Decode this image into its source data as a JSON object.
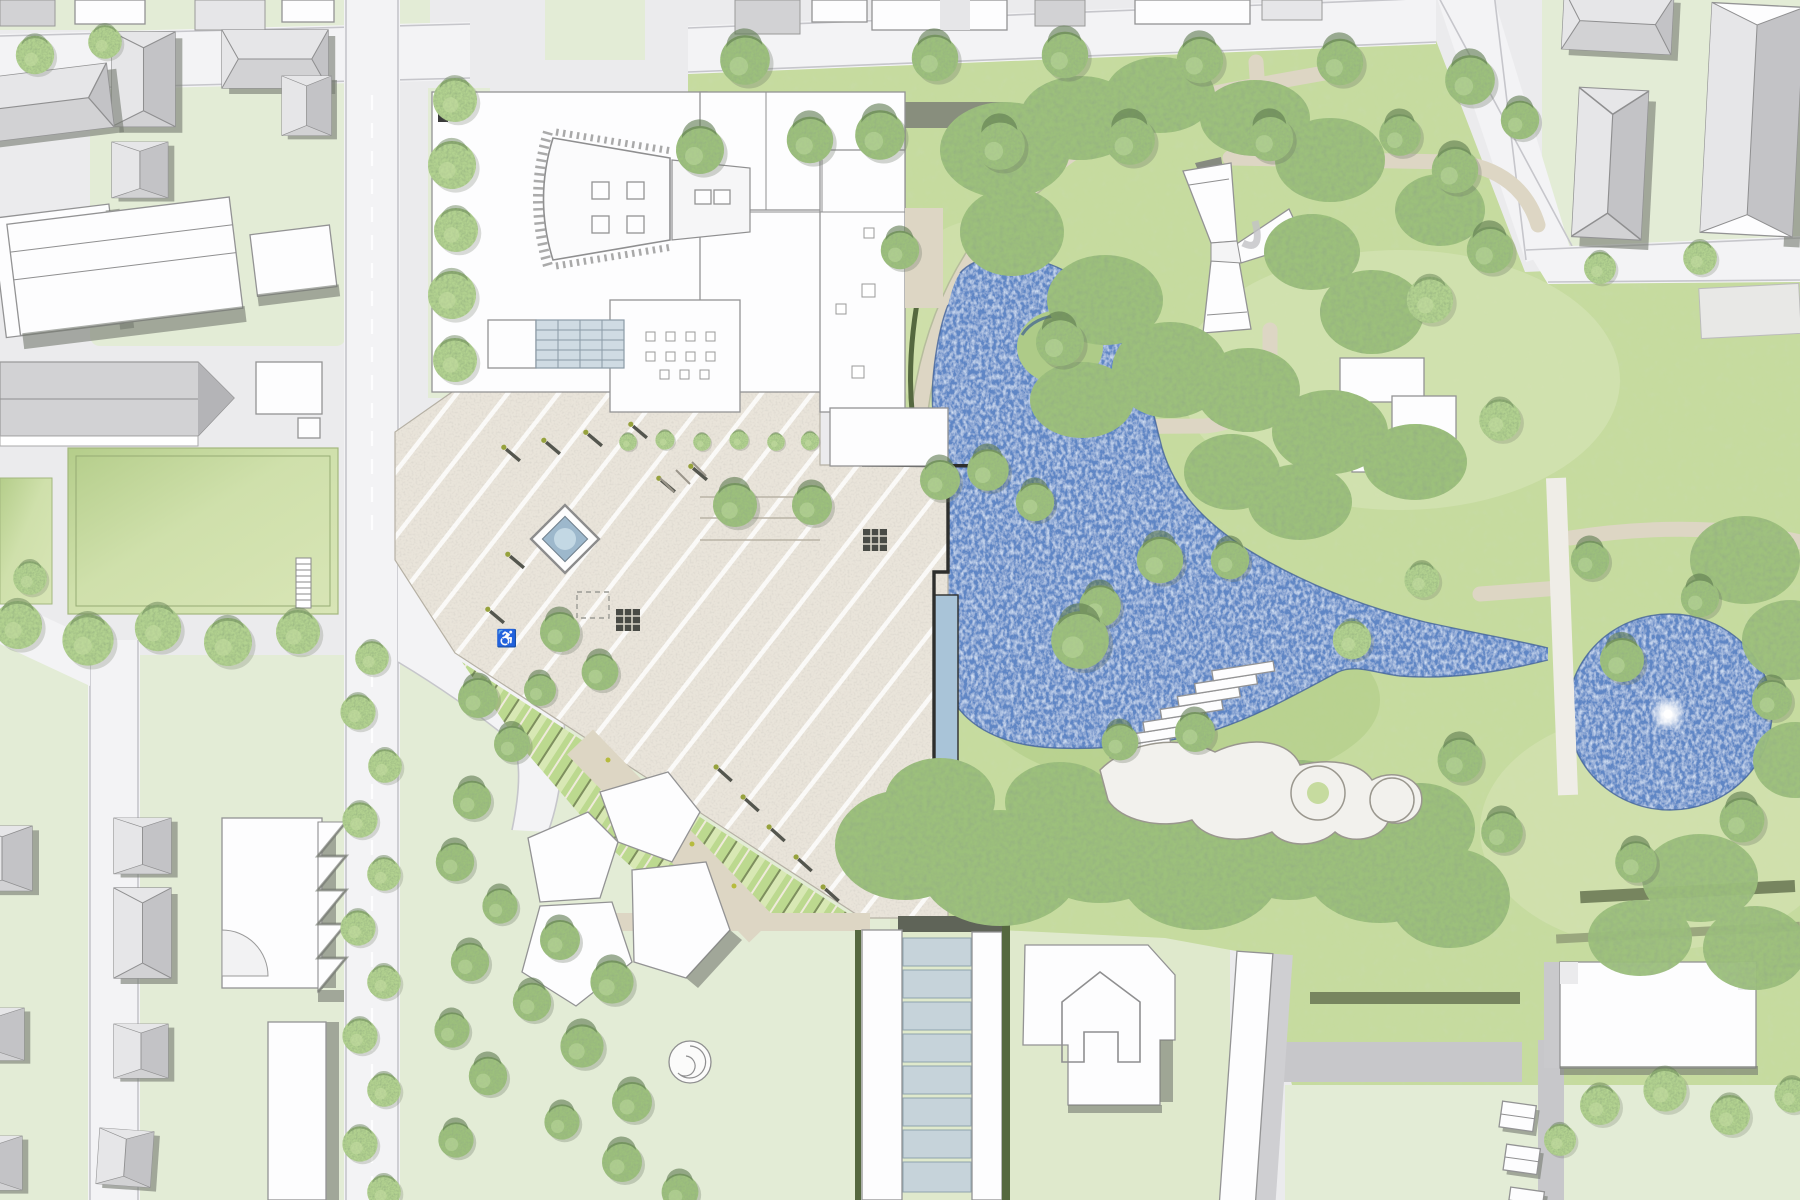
{
  "plan": {
    "type": "architectural-site-plan",
    "symbols": {
      "accessible_parking": "♿"
    },
    "palette": {
      "street": "#ebebed",
      "road": "#f3f3f5",
      "curb": "#c6c6cb",
      "roadgray": "#c7c7ca",
      "block": "#e3ecd6",
      "lawn": "#cfe0ab",
      "park": "#c6db9f",
      "parklight": "#d9e6ba",
      "parkdark": "#a9c87f",
      "tree": "#9cc07c",
      "treelight": "#c4dda3",
      "treedark": "#5d7a4e",
      "treeshadow": "#6b7565",
      "hedge": "#77855f",
      "hedgedark": "#55683f",
      "water": "#5f86c5",
      "waterlight": "#aac7e7",
      "waterdark": "#44639a",
      "plaza": "#e9e4da",
      "stripe": "#ffffff",
      "pathbeige": "#ddd6c4",
      "pathwhite": "#efede7",
      "bwhite": "#fdfdfe",
      "boutline": "#939394",
      "roof": "#d2d2d4",
      "shadow": "#75796f",
      "shadowdark": "#5f6458",
      "glass": "#c6d3da",
      "fountain": "#9db8cc",
      "fountainlight": "#c3d8e4",
      "yellow": "#d9e05e"
    },
    "features": [
      "museum-building",
      "auditorium-fan-roof",
      "skylight-grid",
      "civic-plaza",
      "plaza-fountain",
      "swimming-lake",
      "lake-island",
      "round-pond",
      "pond-fountain",
      "park-meadow",
      "park-paths",
      "lake-bank-steps",
      "playground-shapes",
      "y-shaped-pavilion",
      "terraced-garden",
      "glass-covered-ramp",
      "spiral-stair",
      "church-building",
      "kindergarten-cluster",
      "residential-hip-roof-houses",
      "residential-slab-buildings",
      "tree-allees",
      "street-grid"
    ]
  }
}
